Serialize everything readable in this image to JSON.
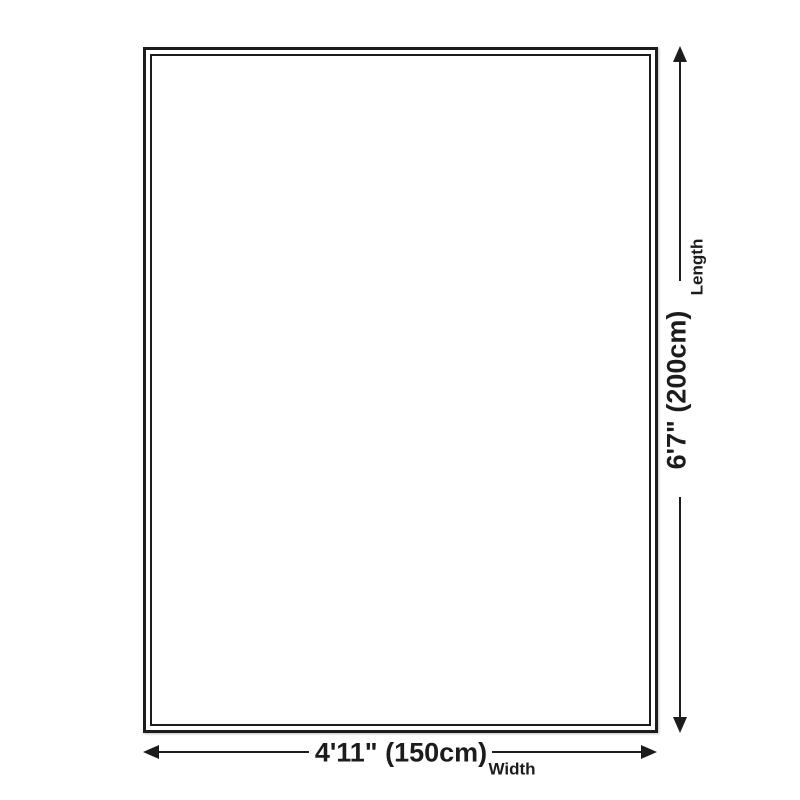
{
  "diagram": {
    "background_color": "#ffffff",
    "line_color": "#1c1c1c",
    "length": {
      "value": "6'7\" (200cm)",
      "label": "Length"
    },
    "width": {
      "value": "4'11\" (150cm)",
      "label": "Width"
    }
  }
}
